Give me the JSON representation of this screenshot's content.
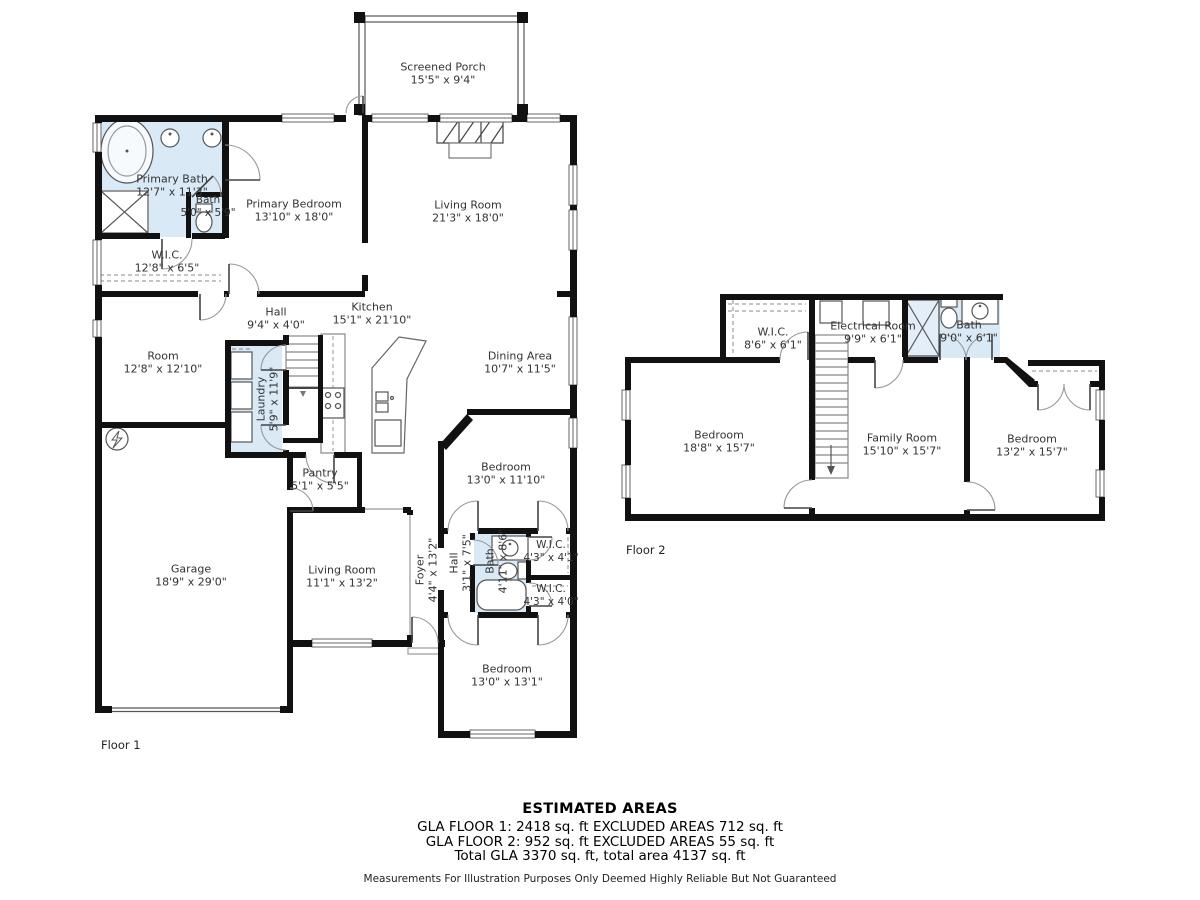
{
  "colors": {
    "wall": "#111111",
    "highlight_fill": "#d9e9f6",
    "text": "#333333"
  },
  "floor1": {
    "label": "Floor 1",
    "rooms": [
      {
        "name": "Screened Porch",
        "dims": "15'5\" x 9'4\""
      },
      {
        "name": "Primary Bath",
        "dims": "12'7\" x 11'3\""
      },
      {
        "name": "Bath",
        "dims": "5'0\" x 5'9\""
      },
      {
        "name": "Primary Bedroom",
        "dims": "13'10\" x 18'0\""
      },
      {
        "name": "Living Room",
        "dims": "21'3\" x 18'0\""
      },
      {
        "name": "W.I.C.",
        "dims": "12'8\" x 6'5\""
      },
      {
        "name": "Hall",
        "dims": "9'4\" x 4'0\""
      },
      {
        "name": "Kitchen",
        "dims": "15'1\" x 21'10\""
      },
      {
        "name": "Dining Area",
        "dims": "10'7\" x 11'5\""
      },
      {
        "name": "Room",
        "dims": "12'8\" x 12'10\""
      },
      {
        "name": "Laundry",
        "dims": "5'9\" x 11'9\""
      },
      {
        "name": "Pantry",
        "dims": "5'1\" x 5'5\""
      },
      {
        "name": "Bedroom",
        "dims": "13'0\" x 11'10\""
      },
      {
        "name": "Garage",
        "dims": "18'9\" x 29'0\""
      },
      {
        "name": "Living Room",
        "dims": "11'1\" x 13'2\""
      },
      {
        "name": "Foyer",
        "dims": "4'4\" x 13'2\""
      },
      {
        "name": "Hall",
        "dims": "3'1\" x 7'5\""
      },
      {
        "name": "Bath",
        "dims": "4'11\" x 8'6\""
      },
      {
        "name": "W.I.C.",
        "dims": "4'3\" x 4'1\""
      },
      {
        "name": "W.I.C.",
        "dims": "4'3\" x 4'0\""
      },
      {
        "name": "Bedroom",
        "dims": "13'0\" x 13'1\""
      }
    ]
  },
  "floor2": {
    "label": "Floor 2",
    "rooms": [
      {
        "name": "W.I.C.",
        "dims": "8'6\" x 6'1\""
      },
      {
        "name": "Electrical Room",
        "dims": "9'9\" x 6'1\""
      },
      {
        "name": "Bath",
        "dims": "9'0\" x 6'1\""
      },
      {
        "name": "Bedroom",
        "dims": "18'8\" x 15'7\""
      },
      {
        "name": "Family Room",
        "dims": "15'10\" x 15'7\""
      },
      {
        "name": "Bedroom",
        "dims": "13'2\" x 15'7\""
      }
    ]
  },
  "summary": {
    "title": "ESTIMATED AREAS",
    "line1": "GLA FLOOR 1: 2418 sq. ft EXCLUDED AREAS 712 sq. ft",
    "line2": "GLA FLOOR 2: 952 sq. ft EXCLUDED AREAS 55 sq. ft",
    "line3": "Total GLA 3370 sq. ft, total area 4137 sq. ft",
    "disclaimer": "Measurements For Illustration Purposes Only Deemed Highly Reliable But Not Guaranteed"
  }
}
